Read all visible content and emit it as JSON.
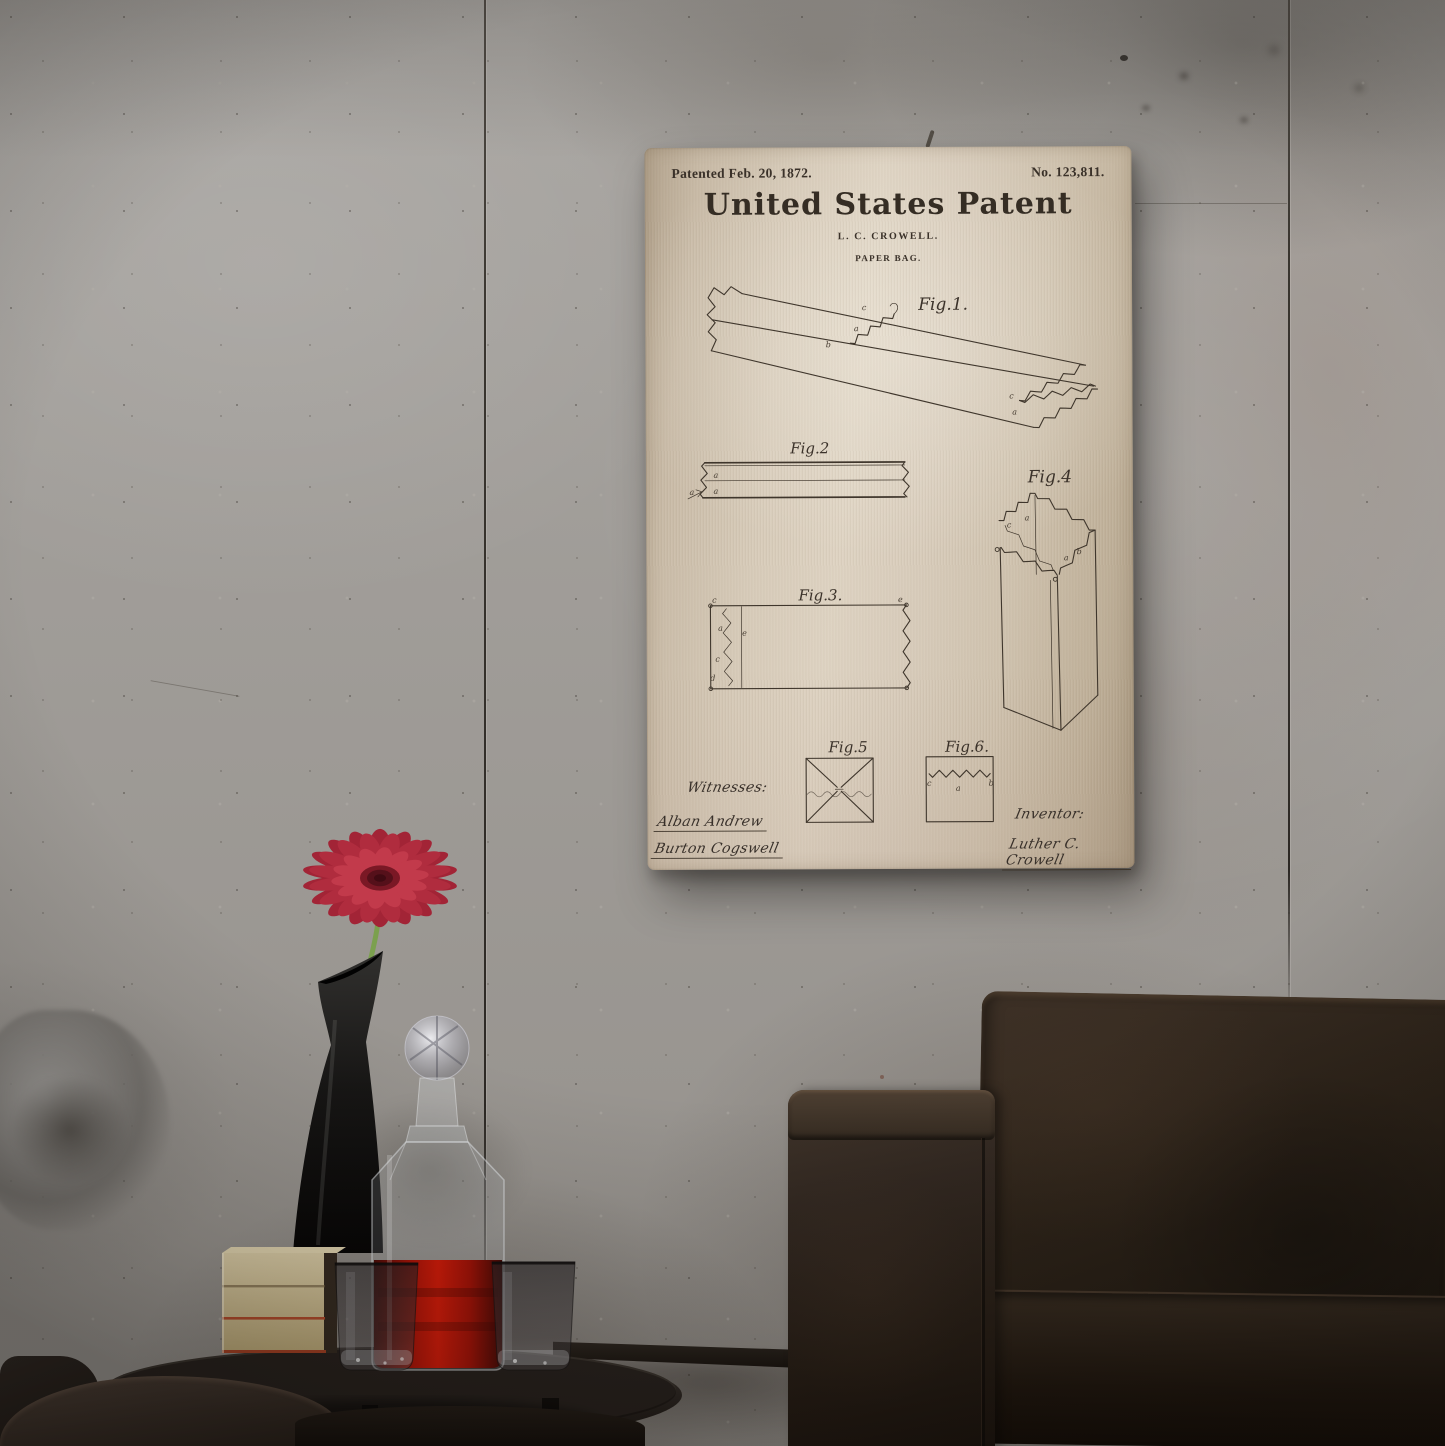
{
  "artwork": {
    "patented_label": "Patented Feb. 20, 1872.",
    "patent_number": "No. 123,811.",
    "title": "United States Patent",
    "byline": "L. C. CROWELL.",
    "subject": "PAPER BAG.",
    "figures": [
      {
        "label": "Fig.1.",
        "annotations": [
          "c",
          "a",
          "b",
          "c",
          "a"
        ]
      },
      {
        "label": "Fig.2",
        "annotations": [
          "a",
          "a",
          "a"
        ]
      },
      {
        "label": "Fig.3.",
        "annotations": [
          "c",
          "a",
          "e",
          "c",
          "d",
          "e"
        ]
      },
      {
        "label": "Fig.4",
        "annotations": [
          "c",
          "a",
          "a",
          "b"
        ]
      },
      {
        "label": "Fig.5",
        "annotations": []
      },
      {
        "label": "Fig.6.",
        "annotations": [
          "c",
          "a",
          "b"
        ]
      }
    ],
    "witnesses_label": "Witnesses:",
    "witness_signatures": [
      "Alban Andrew",
      "Burton Cogswell"
    ],
    "inventor_label": "Inventor:",
    "inventor_signature": "Luther C. Crowell"
  },
  "colors": {
    "poster_paper": "#d7cbb9",
    "poster_ink": "#3a3129",
    "wall": "#9e9b97",
    "liquid_red": "#c01507",
    "flower_red": "#a8293a",
    "leather_brown": "#2c221a"
  }
}
